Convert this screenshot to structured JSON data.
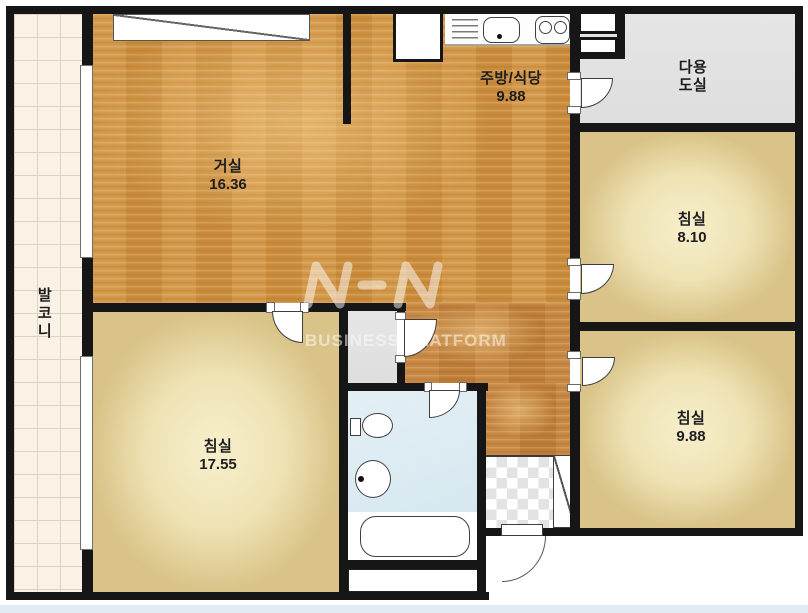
{
  "plan": {
    "title": "아파트 평면도",
    "rooms": {
      "living": {
        "name": "거실",
        "area": "16.36"
      },
      "kitchen": {
        "name": "주방/식당",
        "area": "9.88"
      },
      "utility": {
        "name": "다용\n도실"
      },
      "bedroom1": {
        "name": "침실",
        "area": "8.10"
      },
      "bedroom2": {
        "name": "침실",
        "area": "9.88"
      },
      "bedroom3": {
        "name": "침실",
        "area": "17.55"
      },
      "balcony": {
        "name": "발\n코\n니"
      }
    },
    "watermark": {
      "logo": "NHN",
      "text": "BUSINESS PLATFORM"
    },
    "colors": {
      "wall": "#161616",
      "wood_floor": "#d1923f",
      "bedroom_floor": "#efe3b4",
      "utility_floor": "#e3e3e3",
      "bath_floor": "#dcecf3",
      "balcony_floor": "#fbf2e6",
      "entrance_tile": "#e3e3e3"
    }
  }
}
